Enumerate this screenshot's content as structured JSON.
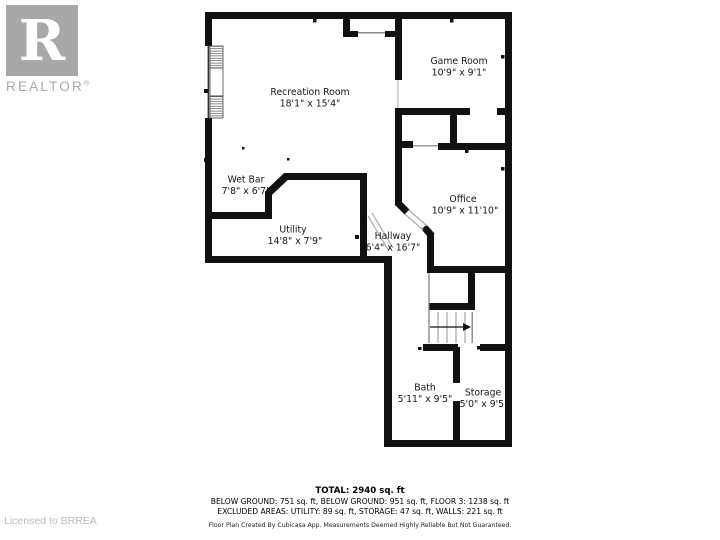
{
  "logo": {
    "letter": "R",
    "brand": "REALTOR",
    "registered": "®"
  },
  "watermark": "Licensed to BRREA",
  "rooms": [
    {
      "id": "recreation-room",
      "name": "Recreation Room",
      "dims": "18'1\" x 15'4\""
    },
    {
      "id": "game-room",
      "name": "Game Room",
      "dims": "10'9\" x 9'1\""
    },
    {
      "id": "wet-bar",
      "name": "Wet Bar",
      "dims": "7'8\" x 6'7\""
    },
    {
      "id": "utility",
      "name": "Utility",
      "dims": "14'8\" x 7'9\""
    },
    {
      "id": "office",
      "name": "Office",
      "dims": "10'9\" x 11'10\""
    },
    {
      "id": "hallway",
      "name": "Hallway",
      "dims": "6'4\" x 16'7\""
    },
    {
      "id": "bath",
      "name": "Bath",
      "dims": "5'11\" x 9'5\""
    },
    {
      "id": "storage",
      "name": "Storage",
      "dims": "5'0\" x 9'5\""
    }
  ],
  "summary": {
    "total": "TOTAL: 2940 sq. ft",
    "areas_line": "BELOW GROUND: 751 sq. ft, BELOW GROUND: 951 sq. ft, FLOOR 3: 1238 sq. ft",
    "excluded_line": "EXCLUDED AREAS: UTILITY: 89 sq. ft, STORAGE: 47 sq. ft, WALLS: 221 sq. ft",
    "disclaimer": "Floor Plan Created By Cubicasa App. Measurements Deemed Highly Reliable But Not Guaranteed."
  },
  "colors": {
    "wall": "#111111",
    "logo_gray": "#a8a8a8",
    "watermark_gray": "#bcbcbc"
  }
}
